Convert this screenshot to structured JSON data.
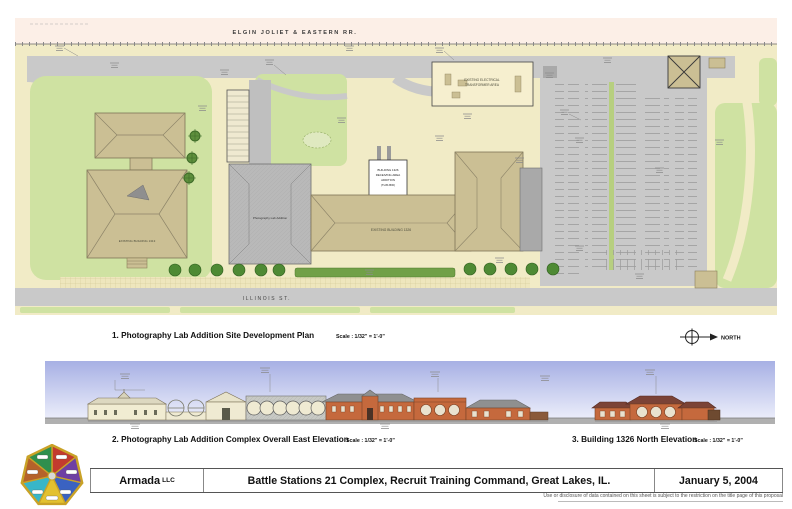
{
  "plan": {
    "railroad_label": "ELGIN JOLIET & EASTERN RR.",
    "street_label": "ILLINOIS ST.",
    "transformer_label_1": "EXISTING ELECTRICAL",
    "transformer_label_2": "TRANSFORMER AREA",
    "existing_building_label": "EXISTING BUILDING 1326",
    "left_building_label": "EXISTING BUILDING 1313",
    "addition_area_label": "Photography Lab Addition",
    "addition_box_lines": [
      "BUILDING 1326",
      "RECEIVING AREA",
      "ADDITION",
      "(THIS BID)"
    ]
  },
  "captions": {
    "plan": {
      "title": "1. Photography Lab Addition Site Development Plan",
      "scale": "Scale : 1/32\" = 1'-0\""
    },
    "north_label": "NORTH",
    "elevation_east": {
      "title": "2. Photography Lab Addition Complex Overall East Elevation",
      "scale": "Scale : 1/32\" = 1'-0\""
    },
    "elevation_north": {
      "title": "3. Building 1326 North Elevation",
      "scale": "Scale : 1/32\" = 1'-0\""
    }
  },
  "title_block": {
    "company": "Armada",
    "company_suffix": "LLC",
    "project": "Battle Stations 21 Complex, Recruit Training Command, Great Lakes, IL.",
    "date": "January 5, 2004",
    "disclaimer": "Use or disclosure of data contained on this sheet is subject to the restriction on the title page of this proposal"
  },
  "colors": {
    "ground": "#f1ebc6",
    "pink_strip": "#fcefe7",
    "grass": "#cfe2a2",
    "road": "#c9c9c9",
    "building_tan": "#cbbf94",
    "roof_gray": "#b9b9b9",
    "brick": "#c5693d",
    "dark_roof": "#7b4336",
    "sky_top": "#a7b0e4",
    "sky_bottom": "#edeffb",
    "logo_gold": "#c9a227"
  }
}
